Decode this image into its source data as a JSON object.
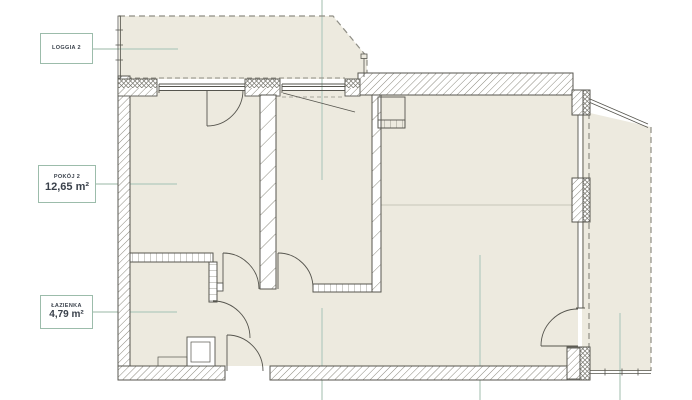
{
  "plan": {
    "labels": {
      "loggia": {
        "name": "LOGGIA 2"
      },
      "room2": {
        "name": "POKÓJ 2",
        "area": "12,65 m²"
      },
      "bathroom": {
        "name": "ŁAZIENKA",
        "area": "4,79 m²"
      }
    },
    "colors": {
      "floor_fill": "#edeadf",
      "wall_line": "#56554e",
      "hatch_line": "#8b897e",
      "leader_line": "#bccfc4",
      "label_border": "#9cbcab",
      "label_text": "#3a414b",
      "dashed_line": "#8f8e85",
      "background": "#ffffff"
    }
  }
}
